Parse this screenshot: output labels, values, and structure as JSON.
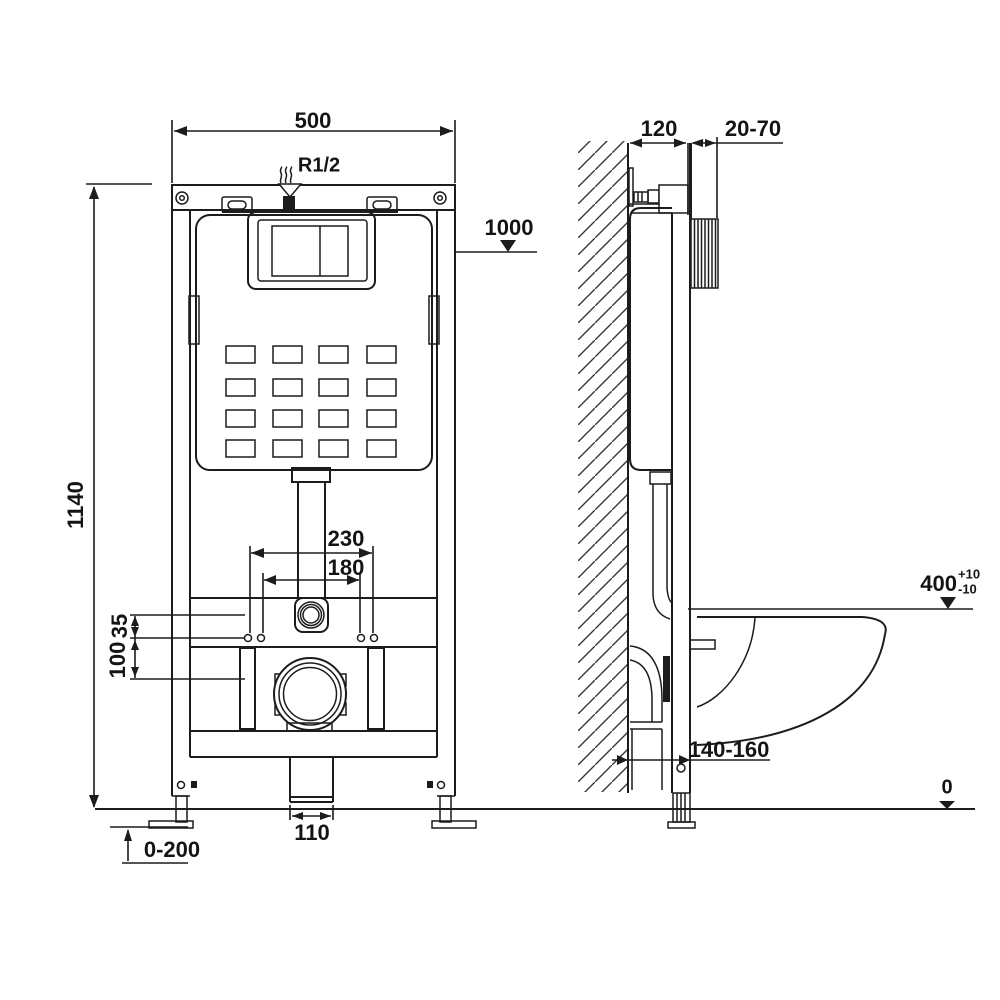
{
  "drawing": {
    "type": "technical installation drawing",
    "subject": "Wall-hung WC concealed cistern mounting frame, front and side view",
    "line_color": "#1c1c1c",
    "background": "#ffffff"
  },
  "front_view": {
    "name": "front view",
    "dims": {
      "frame_width": "500",
      "inlet_thread": "R1/2",
      "button_level": "1000",
      "frame_height": "1140",
      "fixing_span_outer": "230",
      "fixing_span_inner": "180",
      "offset_upper": "35",
      "offset_lower": "100",
      "outlet_width": "110",
      "leg_adjustment": "0-200"
    }
  },
  "side_view": {
    "name": "side view",
    "dims": {
      "frame_depth": "120",
      "finish_range": "20-70",
      "bowl_level": "400",
      "bowl_level_plus": "+10",
      "bowl_level_minus": "-10",
      "drain_distance": "140-160",
      "floor_level": "0"
    }
  }
}
